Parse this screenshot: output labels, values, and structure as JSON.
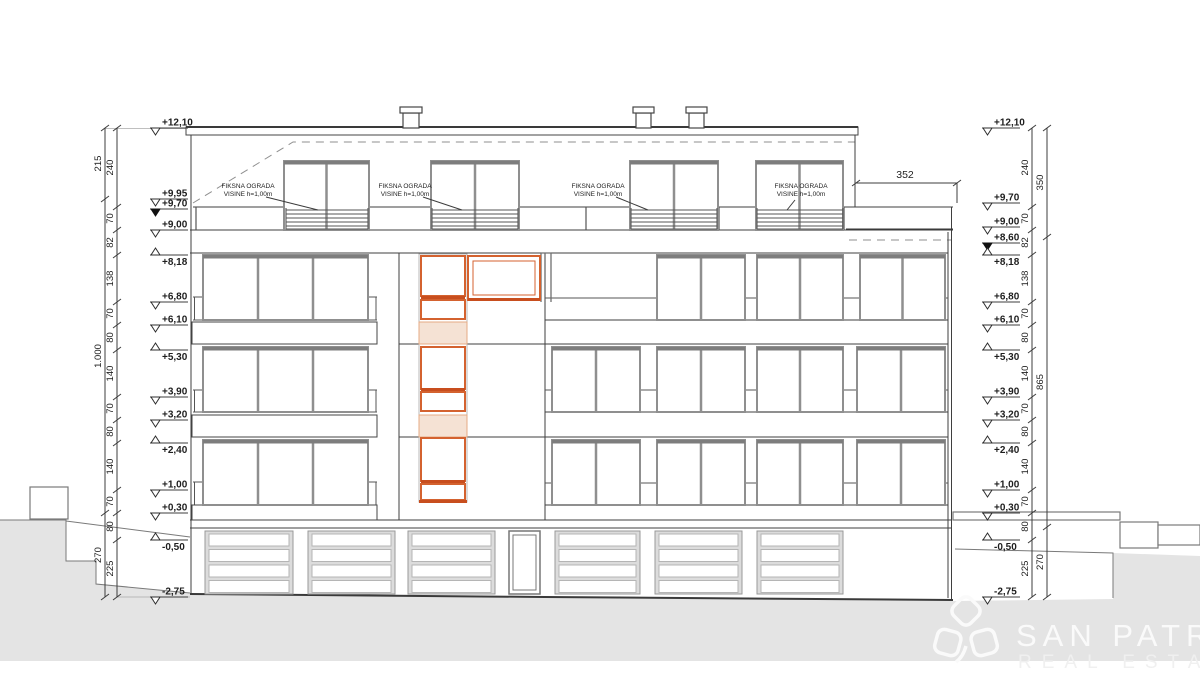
{
  "drawing_type": "building street elevation",
  "elevation_markers_left": [
    "+12,10",
    "+9,95",
    "+9,70",
    "+9,00",
    "+8,18",
    "+6,80",
    "+6,10",
    "+5,30",
    "+3,90",
    "+3,20",
    "+2,40",
    "+1,00",
    "+0,30",
    "-0,50",
    "-2,75"
  ],
  "elevation_markers_right": [
    "+12,10",
    "+9,70",
    "+9,00",
    "+8,60",
    "+8,18",
    "+6,80",
    "+6,10",
    "+5,30",
    "+3,90",
    "+3,20",
    "+2,40",
    "+1,00",
    "+0,30",
    "-0,50",
    "-2,75"
  ],
  "dim_chain_inner": [
    "240",
    "70",
    "82",
    "138",
    "70",
    "80",
    "140",
    "70",
    "80",
    "140",
    "70",
    "80",
    "225"
  ],
  "dim_chain_left_outer": [
    "215",
    "1.000",
    "270"
  ],
  "dim_chain_right_outer": [
    "350",
    "865",
    "270"
  ],
  "dim_top_right": "352",
  "railing_labels": [
    {
      "line1": "FIKSNA OGRADA",
      "line2": "VISINE h=1,00m"
    },
    {
      "line1": "FIKSNA OGRADA",
      "line2": "VISINE h=1,00m"
    },
    {
      "line1": "FIKSNA OGRADA",
      "line2": "VISINE h=1,00m"
    },
    {
      "line1": "FIKSNA OGRADA",
      "line2": "VISINE h=1,00m"
    }
  ],
  "logo": {
    "name": "SAN PATRIK",
    "subtitle": "REAL ESTATE"
  },
  "colors": {
    "highlight_orange": "#d4622f",
    "highlight_orange_dark": "#c84e1e",
    "highlight_orange_pale": "#f5e2d4",
    "ground_gray": "#e4e4e4",
    "line_dark": "#3f3f3f",
    "window_frame_gray": "#8f8f8f",
    "logo_white": "#fafafa"
  }
}
